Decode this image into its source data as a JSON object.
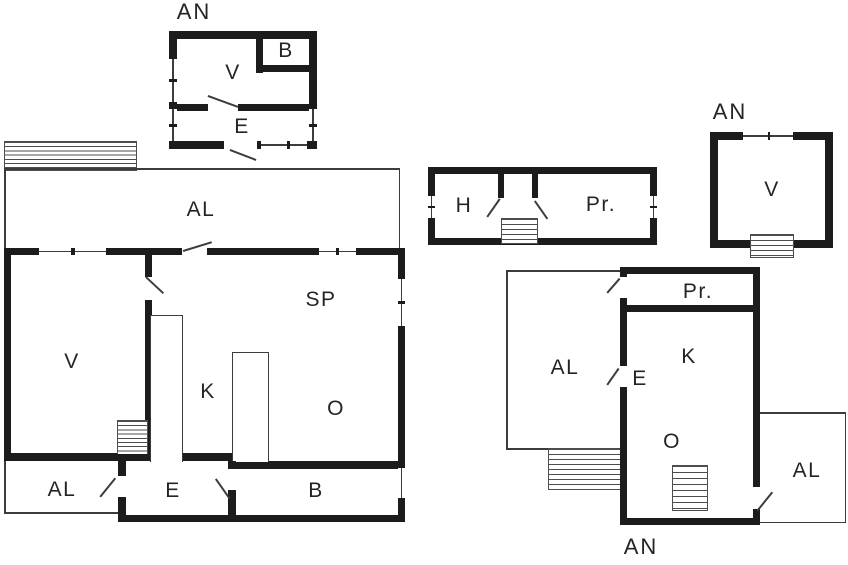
{
  "plans": {
    "attic_left": {
      "title": "AN",
      "rooms": {
        "v": "V",
        "b": "B",
        "e": "E"
      }
    },
    "main_house": {
      "rooms": {
        "al_upper": "AL",
        "v": "V",
        "k": "K",
        "sp": "SP",
        "o": "O",
        "al_lower": "AL",
        "e": "E",
        "b": "B"
      }
    },
    "outbuilding": {
      "rooms": {
        "h": "H",
        "pr": "Pr."
      }
    },
    "attic_right": {
      "title": "AN",
      "rooms": {
        "v": "V"
      }
    },
    "second_house": {
      "title": "AN",
      "rooms": {
        "pr": "Pr.",
        "k": "K",
        "e": "E",
        "o": "O",
        "al_left": "AL",
        "al_right": "AL"
      }
    }
  },
  "colors": {
    "wall": "#1c1c1c",
    "thin_line": "#3c3c3c",
    "text": "#242424",
    "background": "#ffffff"
  }
}
